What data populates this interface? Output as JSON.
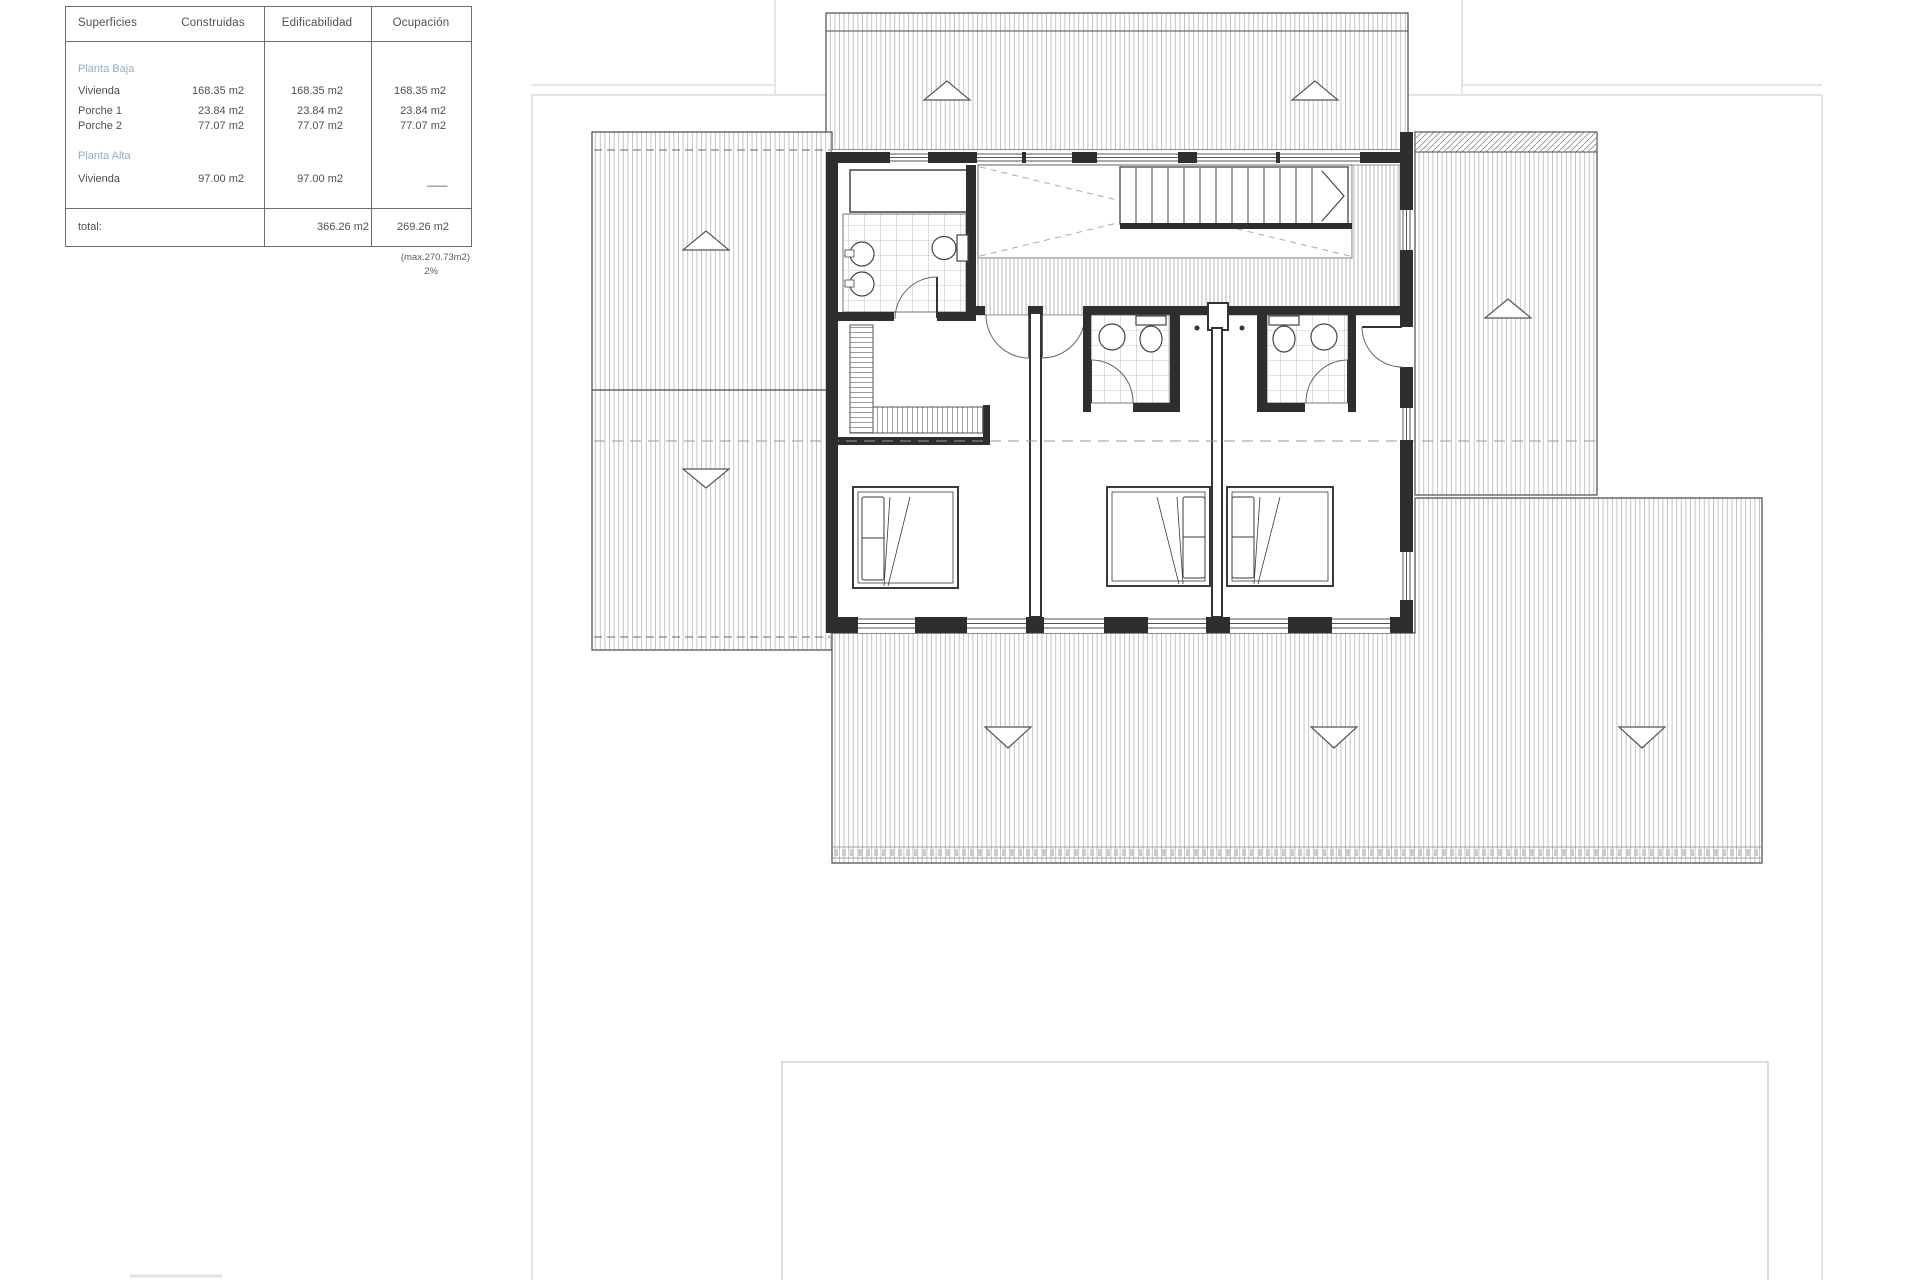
{
  "table": {
    "headers": [
      "Superficies",
      "Construidas",
      "Edificabilidad",
      "Ocupación"
    ],
    "planta_baja": {
      "label": "Planta Baja",
      "rows": [
        {
          "name": "Vivienda",
          "construidas": "168.35 m2",
          "edificabilidad": "168.35 m2",
          "ocupacion": "168.35 m2"
        },
        {
          "name": "Porche 1",
          "construidas": "23.84 m2",
          "edificabilidad": "23.84 m2",
          "ocupacion": "23.84 m2"
        },
        {
          "name": "Porche 2",
          "construidas": "77.07 m2",
          "edificabilidad": "77.07 m2",
          "ocupacion": "77.07 m2"
        }
      ]
    },
    "planta_alta": {
      "label": "Planta Alta",
      "rows": [
        {
          "name": "Vivienda",
          "construidas": "97.00 m2",
          "edificabilidad": "97.00 m2",
          "ocupacion": "——"
        }
      ]
    },
    "total": {
      "label": "total:",
      "edificabilidad": "366.26 m2",
      "ocupacion": "269.26 m2"
    },
    "footnote_max": "(max.270.73m2)",
    "footnote_pct": "2%"
  },
  "colors": {
    "wall": "#2e2e2e",
    "roof_hatch": "#b5b5b5",
    "planta_label_blue": "#8fb0c0",
    "site_boundary": "#dcdcdc",
    "table_text": "#4f4f4f"
  }
}
